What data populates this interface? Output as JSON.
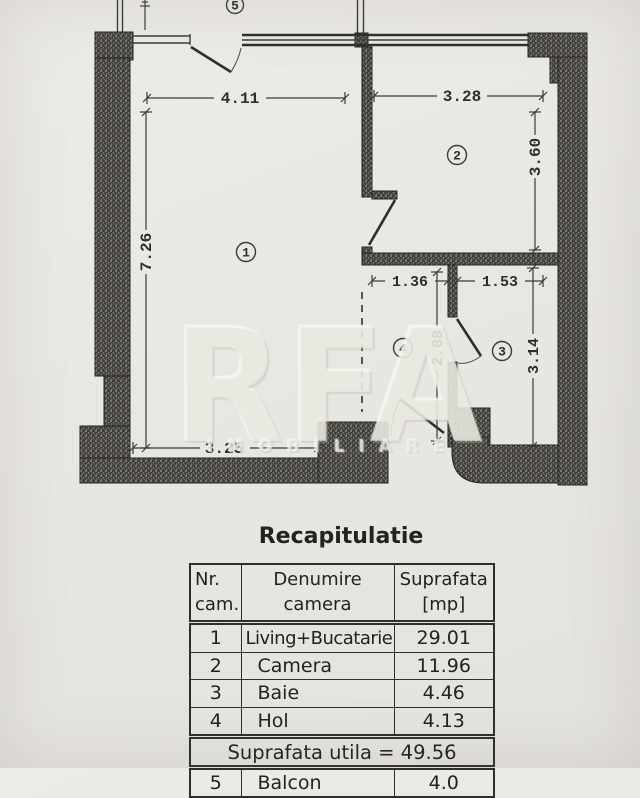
{
  "colors": {
    "paper": "#e9e7e2",
    "ink": "#2e2e2c",
    "wall_dark": "#3e3d38",
    "wall_dot": "#aaa79c"
  },
  "plan": {
    "room_numbers": {
      "living": "1",
      "camera": "2",
      "baie": "3",
      "hol": "4",
      "balcon": "5"
    },
    "dims": {
      "living_width": "4.11",
      "living_height": "7.26",
      "living_bottom": "3.25",
      "camera_width": "3.28",
      "camera_height": "3.60",
      "hol_width": "1.36",
      "hol_height": "2.88",
      "baie_width": "1.53",
      "baie_height": "3.14"
    },
    "watermark": {
      "brand": "RFA",
      "subtext": "IMOBILIARE"
    }
  },
  "recap": {
    "title": "Recapitulatie",
    "columns": [
      {
        "line1": "Nr.",
        "line2": "cam."
      },
      {
        "line1": "Denumire",
        "line2": "camera"
      },
      {
        "line1": "Suprafata",
        "line2": "[mp]"
      }
    ],
    "rows": [
      {
        "nr": "1",
        "name": "Living+Bucatarie",
        "area": "29.01"
      },
      {
        "nr": "2",
        "name": "Camera",
        "area": "11.96"
      },
      {
        "nr": "3",
        "name": "Baie",
        "area": "4.46"
      },
      {
        "nr": "4",
        "name": "Hol",
        "area": "4.13"
      }
    ],
    "summary": "Suprafata utila = 49.56",
    "partial_row": {
      "nr": "5",
      "name": "Balcon",
      "area": "4.0"
    }
  }
}
